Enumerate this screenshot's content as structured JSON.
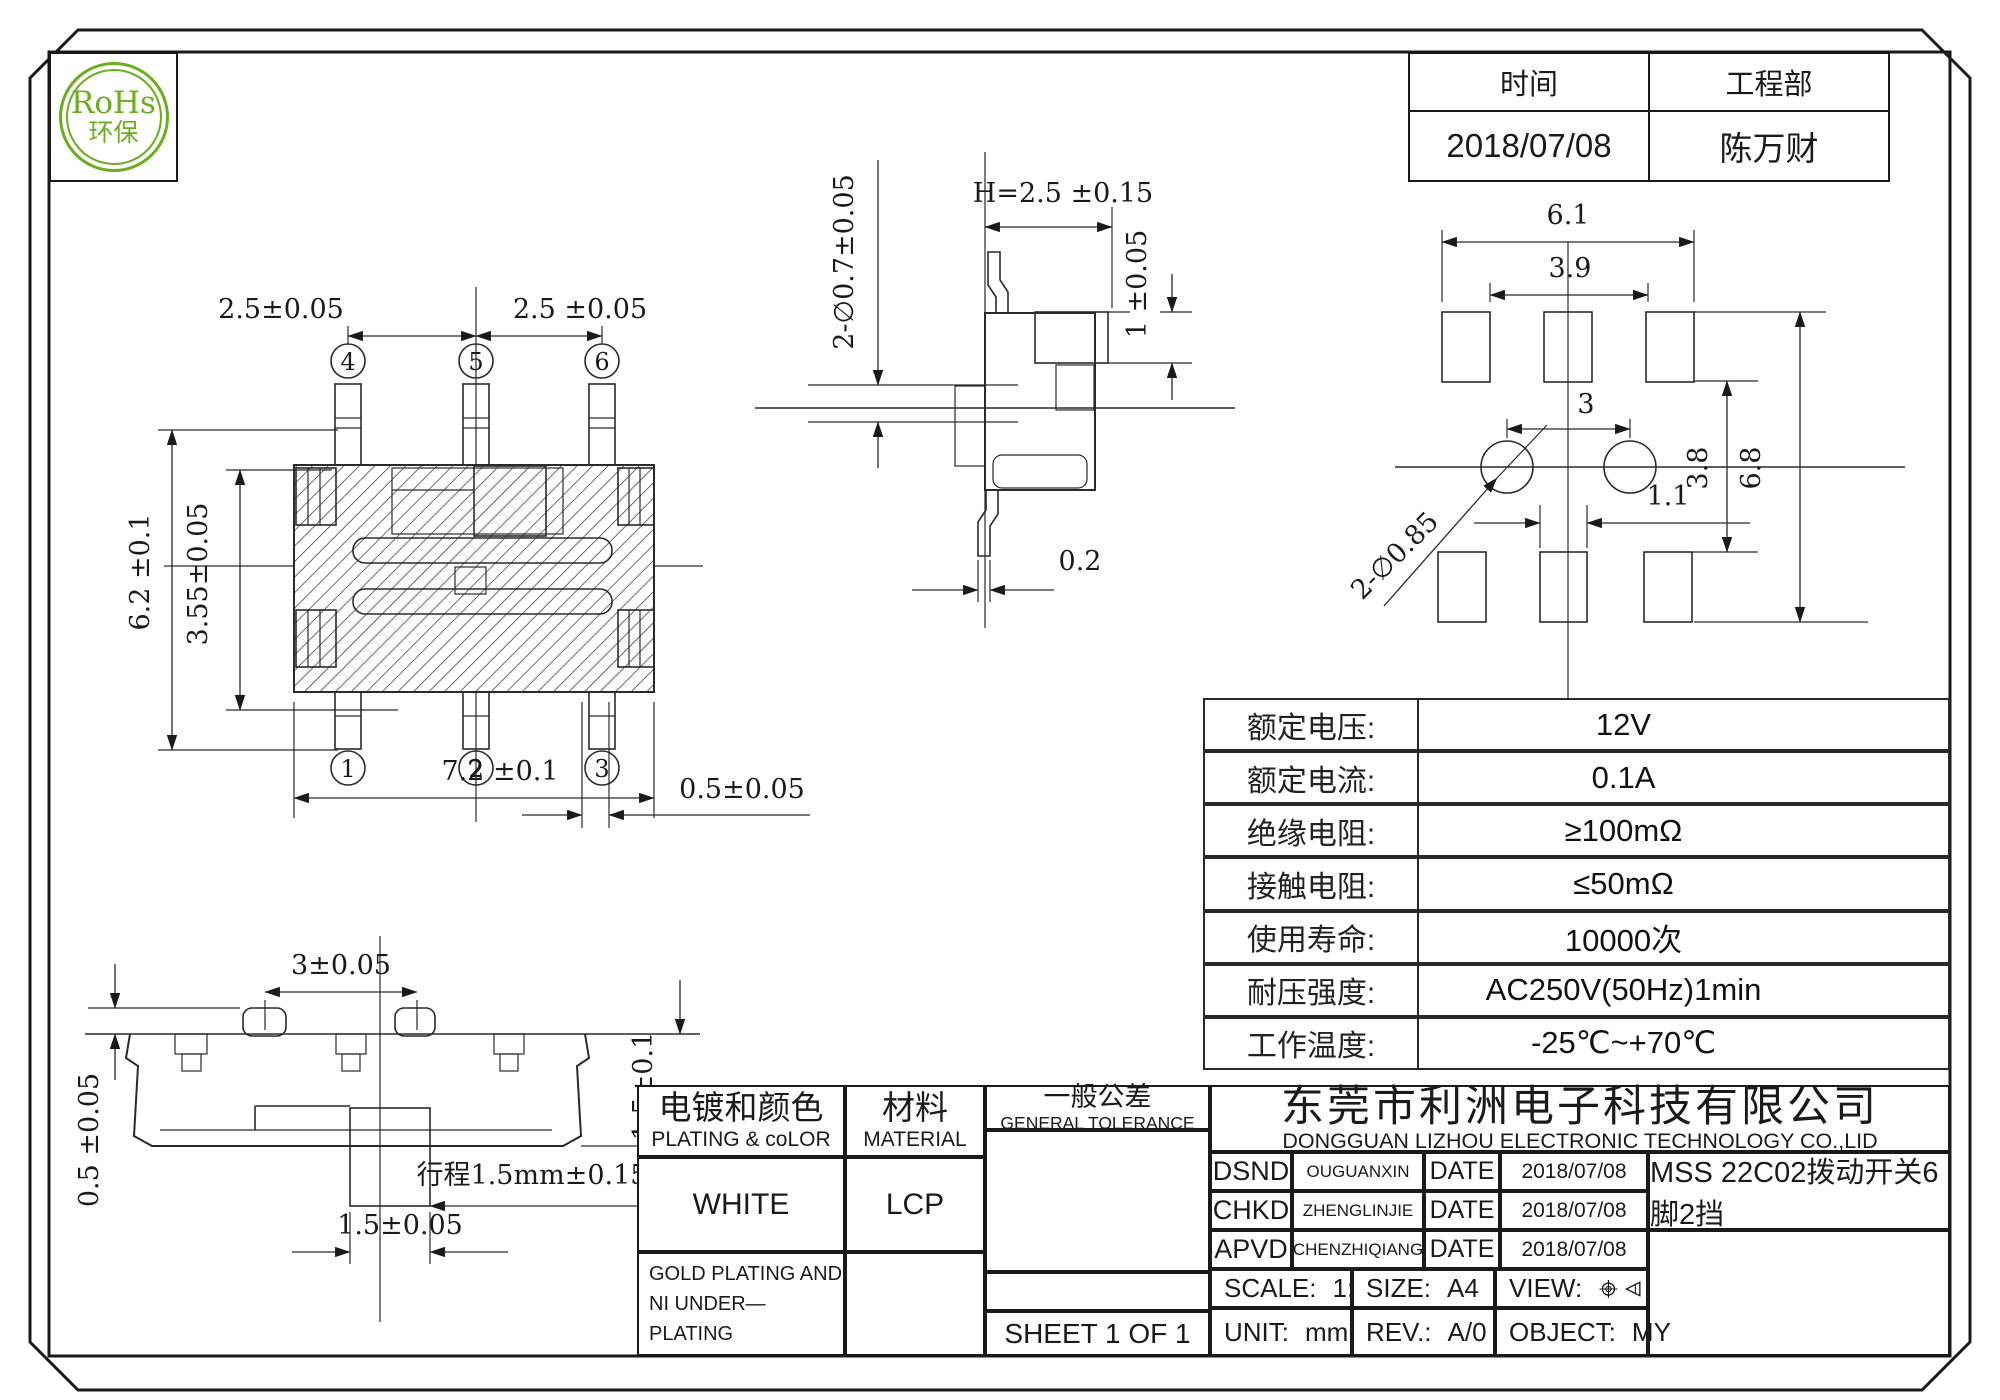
{
  "rohs": {
    "title": "RoHs",
    "subtitle": "环保"
  },
  "header_table": {
    "time_label": "时间",
    "dept_label": "工程部",
    "time_value": "2018/07/08",
    "dept_value": "陈万财"
  },
  "specs": {
    "rows": [
      {
        "label": "额定电压:",
        "value": "12V"
      },
      {
        "label": "额定电流:",
        "value": "0.1A"
      },
      {
        "label": "绝缘电阻:",
        "value": "≥100mΩ"
      },
      {
        "label": "接触电阻:",
        "value": "≤50mΩ"
      },
      {
        "label": "使用寿命:",
        "value": "10000次"
      },
      {
        "label": "耐压强度:",
        "value": "AC250V(50Hz)1min"
      },
      {
        "label": "工作温度:",
        "value": "-25℃~+70℃"
      }
    ]
  },
  "title_block": {
    "plating_cn": "电镀和颜色",
    "plating_en": "PLATING & coLOR",
    "plating_value": "WHITE",
    "plating_note1": "GOLD PLATING AND",
    "plating_note2": "NI UNDER—PLATING",
    "material_cn": "材料",
    "material_en": "MATERIAL",
    "material_value": "LCP",
    "tolerance_cn": "一般公差",
    "tolerance_en": "GENERAL TOLERANCE",
    "sheet": "SHEET 1 OF 1",
    "company_cn": "东莞市利洲电子科技有限公司",
    "company_en": "DONGGUAN LIZHOU ELECTRONIC TECHNOLOGY CO.,LID",
    "rows": [
      {
        "role": "DSND",
        "name": "OUGUANXIN",
        "date_label": "DATE",
        "date_value": "2018/07/08"
      },
      {
        "role": "CHKD",
        "name": "ZHENGLINJIE",
        "date_label": "DATE",
        "date_value": "2018/07/08"
      },
      {
        "role": "APVD",
        "name": "CHENZHIQIANG",
        "date_label": "DATE",
        "date_value": "2018/07/08"
      }
    ],
    "part_title": "MSS 22C02拨动开关6脚2挡",
    "scale_label": "SCALE:",
    "scale_value": "1:1",
    "size_label": "SIZE:",
    "size_value": "A4",
    "view_label": "VIEW:",
    "unit_label": "UNIT:",
    "unit_value": "mm",
    "rev_label": "REV.:",
    "rev_value": "A/0",
    "object_label": "OBJECT:",
    "object_value": "MY"
  },
  "views": {
    "top": {
      "pin4": "4",
      "pin5": "5",
      "pin6": "6",
      "pin1": "1",
      "pin2": "2",
      "pin3": "3",
      "dim_pitch_left": "2.5±0.05",
      "dim_pitch_right": "2.5 ±0.05",
      "dim_body_height": "6.2 ±0.1",
      "dim_inner_height": "3.55±0.05",
      "dim_body_width": "7.2 ±0.1",
      "dim_pin_width": "0.5±0.05"
    },
    "side": {
      "dim_holes": "2-∅0.7±0.05",
      "dim_height": "H=2.5 ±0.15",
      "dim_knob": "1 ±0.05",
      "dim_pin_thickness": "0.2"
    },
    "footprint": {
      "dim_outer_width": "6.1",
      "dim_inner_width": "3.9",
      "dim_hole_pitch": "3",
      "dim_holes": "2-∅0.85",
      "dim_pad_width": "1.1",
      "dim_row_gap": "3.8",
      "dim_outer_height": "6.8"
    },
    "front": {
      "dim_bump_pitch": "3±0.05",
      "dim_bump_height": "0.5 ±0.05",
      "dim_shell_height": "1.5±0.1",
      "dim_travel": "行程1.5mm±0.15",
      "dim_slider_width": "1.5±0.05"
    }
  }
}
